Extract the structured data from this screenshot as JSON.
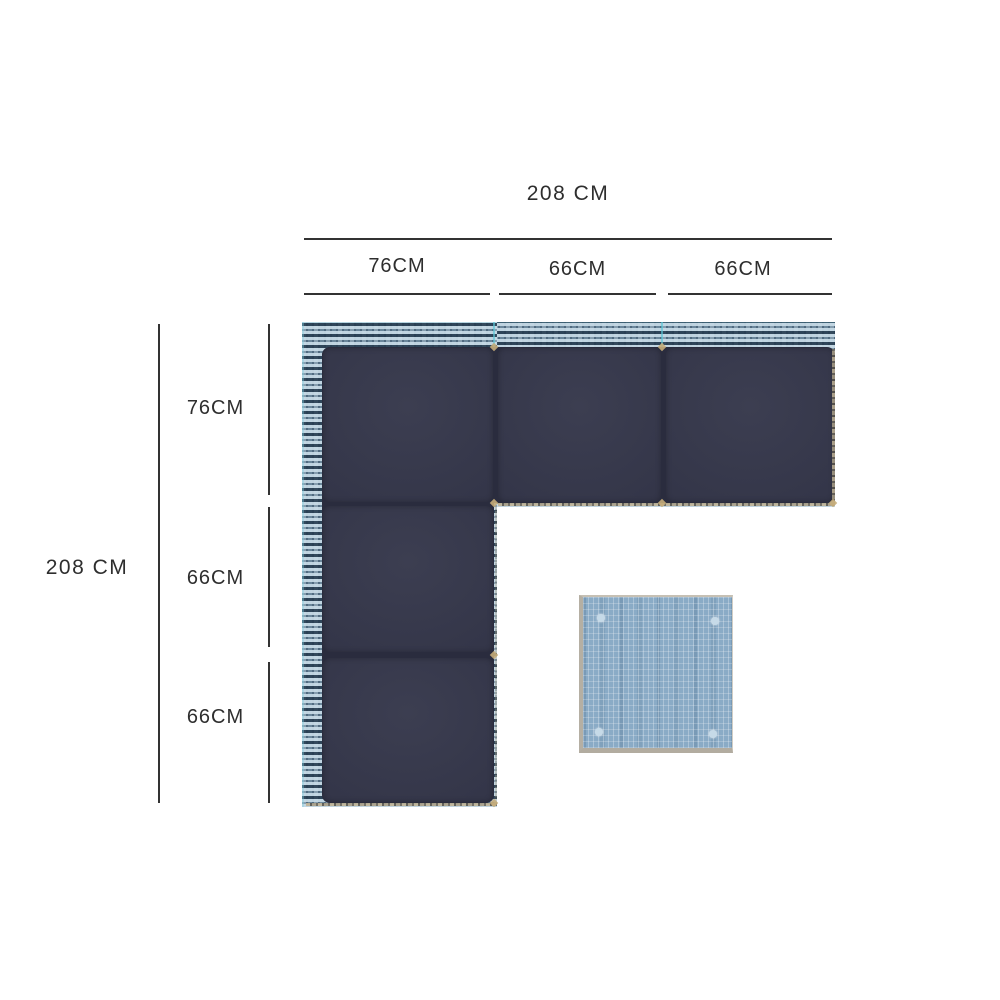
{
  "diagram_title": "corner-sofa-dimension-diagram",
  "dims": {
    "top": {
      "total": "208 CM",
      "segments": [
        "76CM",
        "66CM",
        "66CM"
      ]
    },
    "left": {
      "total": "208 CM",
      "segments": [
        "76CM",
        "66CM",
        "66CM"
      ]
    }
  },
  "colors": {
    "text": "#2e2e2e",
    "line": "#333333",
    "cushion_navy": "#343649",
    "wicker_blue": "#9db8ca",
    "table_blue": "#8aabc6",
    "edge_tan": "#bfb295",
    "background": "#ffffff"
  }
}
